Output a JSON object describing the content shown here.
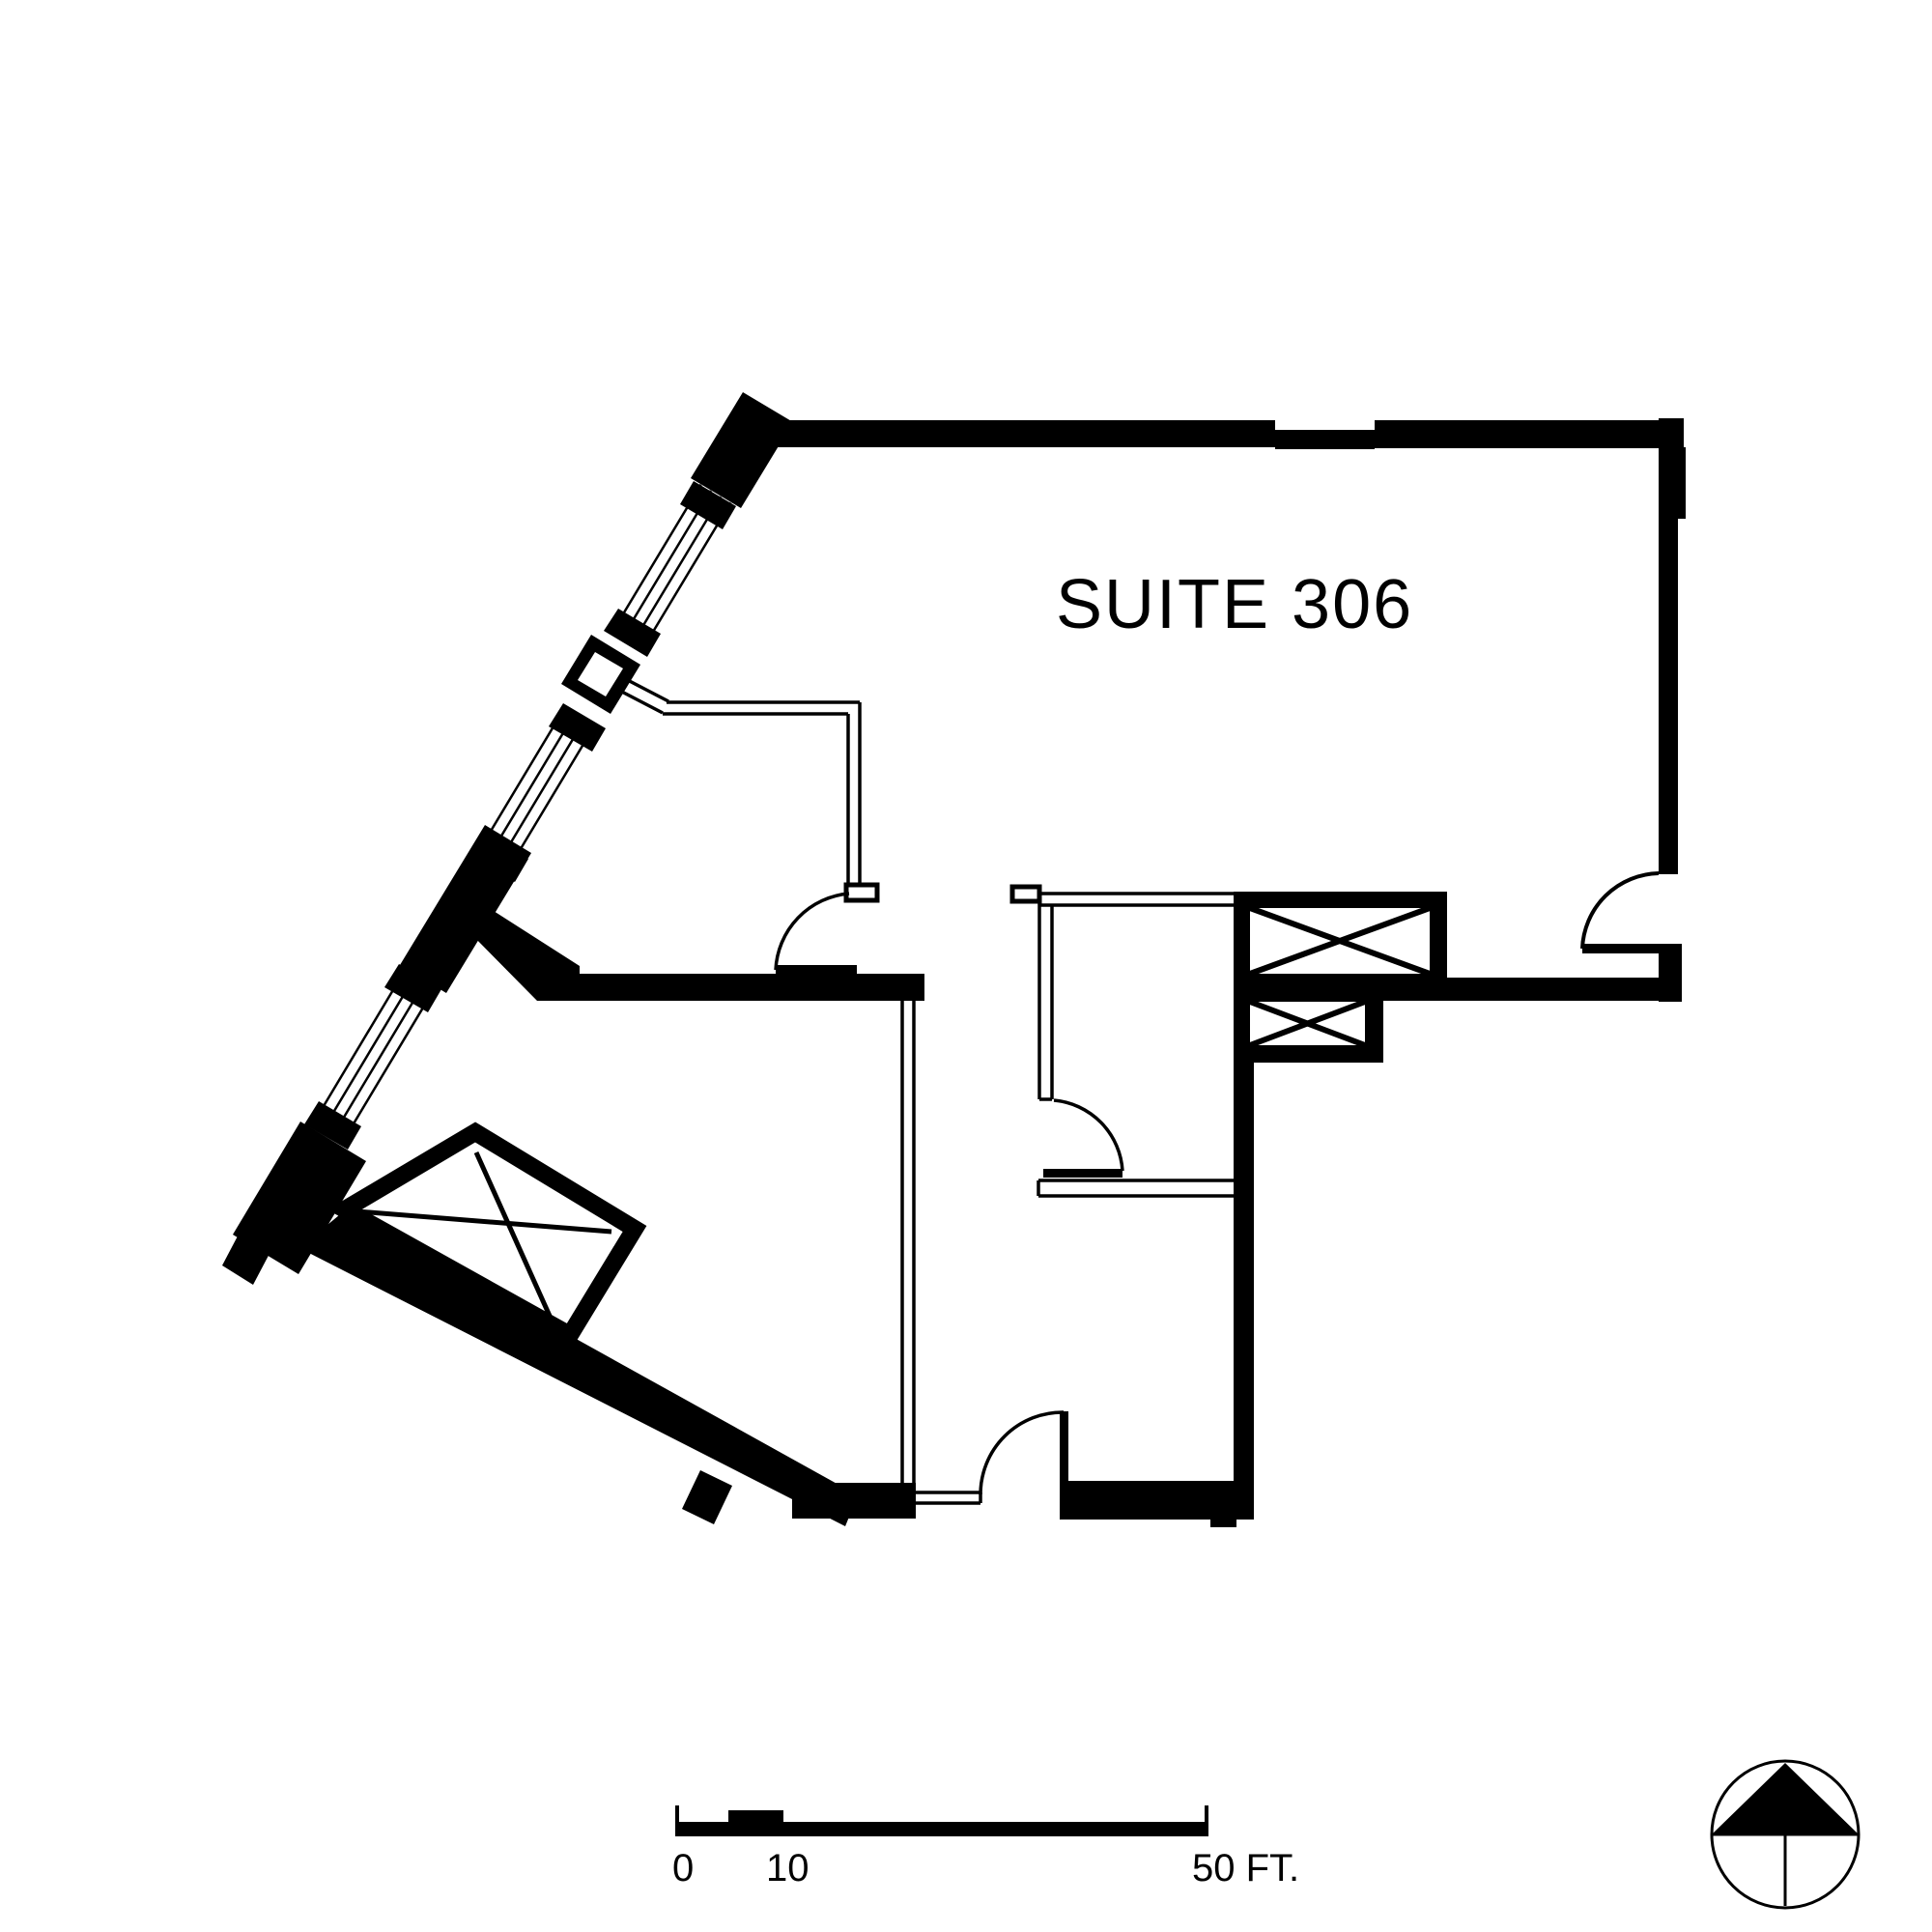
{
  "title": {
    "text": "SUITE 306"
  },
  "scale_bar": {
    "label_0": "0",
    "label_10": "10",
    "label_50": "50 FT.",
    "units": "FT",
    "range_ft": 50,
    "first_division_ft": 10
  },
  "icons": {
    "north_arrow": "north-arrow-compass"
  },
  "colors": {
    "ink": "#000000",
    "paper": "#ffffff"
  },
  "plan": {
    "suite_number": "306",
    "features": [
      "angled-window-wall-northwest",
      "entry-door-east",
      "two-elevator-shafts-with-x",
      "skylight-shaft-with-x-southwest",
      "three-interior-doors",
      "thin-partition-walls"
    ]
  }
}
